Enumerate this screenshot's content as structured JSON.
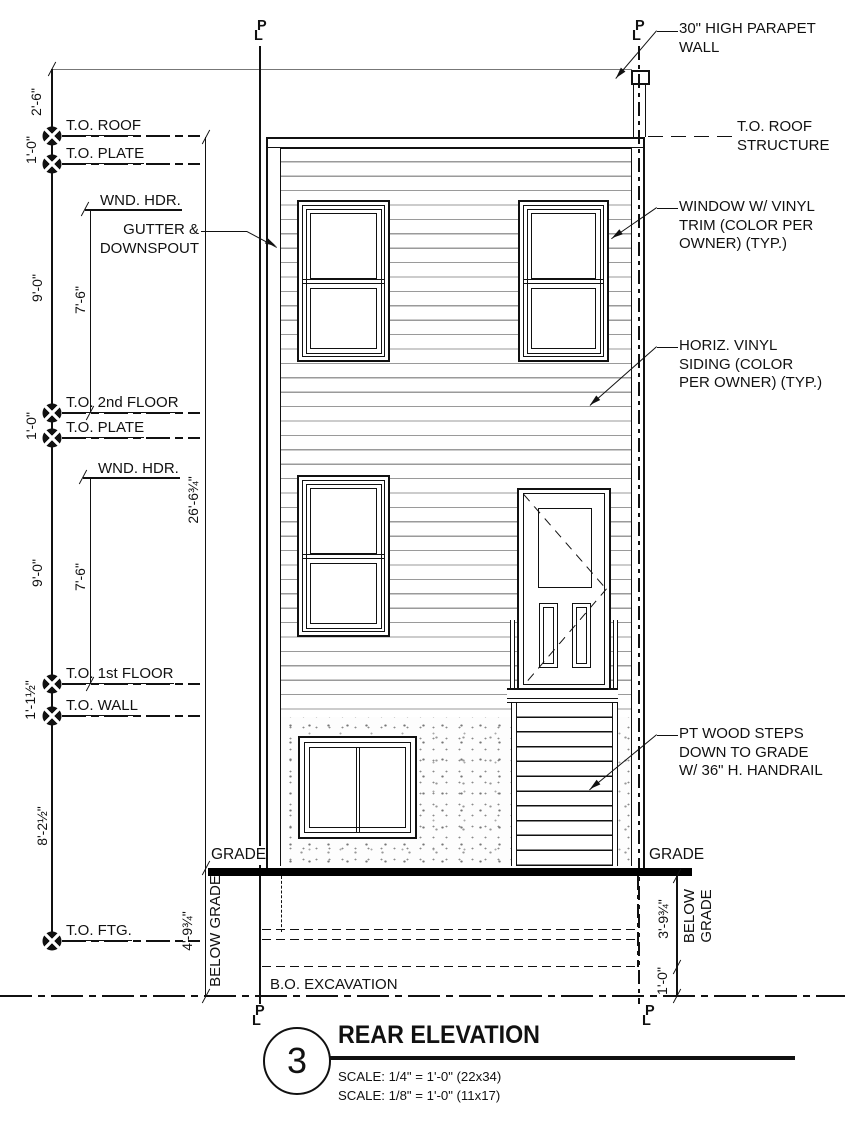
{
  "sheet": {
    "number": "3",
    "title": "REAR ELEVATION",
    "scale_1": "SCALE: 1/4\" = 1'-0\" (22x34)",
    "scale_2": "SCALE: 1/8\" = 1'-0\" (11x17)"
  },
  "datums": {
    "to_roof": "T.O. ROOF",
    "to_plate_upper": "T.O. PLATE",
    "to_2nd_floor": "T.O. 2nd FLOOR",
    "to_plate_lower": "T.O. PLATE",
    "to_1st_floor": "T.O. 1st FLOOR",
    "to_wall": "T.O. WALL",
    "to_ftg": "T.O. FTG.",
    "wnd_hdr_upper": "WND. HDR.",
    "wnd_hdr_lower": "WND. HDR.",
    "to_roof_structure": "T.O. ROOF\nSTRUCTURE",
    "bo_excavation": "B.O. EXCAVATION",
    "grade_left": "GRADE",
    "grade_right": "GRADE",
    "below_grade_left": "BELOW GRADE",
    "below_grade_right": "BELOW\nGRADE"
  },
  "dimensions": {
    "parapet_height": "2'-6\"",
    "roof_to_plate": "1'-0\"",
    "upper_floor_height": "9'-0\"",
    "upper_wnd_hdr": "7'-6\"",
    "floor2_to_plate": "1'-0\"",
    "lower_floor_height": "9'-0\"",
    "lower_wnd_hdr": "7'-6\"",
    "floor1_to_wall": "1'-1½\"",
    "wall_to_ftg": "8'-2½\"",
    "overall_height": "26'-6¾\"",
    "grade_to_excav_left": "4'-9¾\"",
    "grade_to_ftg_right": "3'-9¾\"",
    "ftg_to_excav_right": "1'-0\""
  },
  "annotations": {
    "parapet": "30\" HIGH PARAPET\nWALL",
    "window": "WINDOW W/ VINYL\nTRIM (COLOR PER\nOWNER) (TYP.)",
    "siding": "HORIZ. VINYL\nSIDING (COLOR\nPER OWNER) (TYP.)",
    "steps": "PT WOOD STEPS\nDOWN TO GRADE\nW/ 36\" H. HANDRAIL",
    "gutter": "GUTTER &\nDOWNSPOUT"
  },
  "markers": {
    "pl_p": "P",
    "pl_l": "L"
  },
  "colors": {
    "line": "#111111",
    "siding_line": "#9a9a9a",
    "grade_bar": "#000000"
  }
}
